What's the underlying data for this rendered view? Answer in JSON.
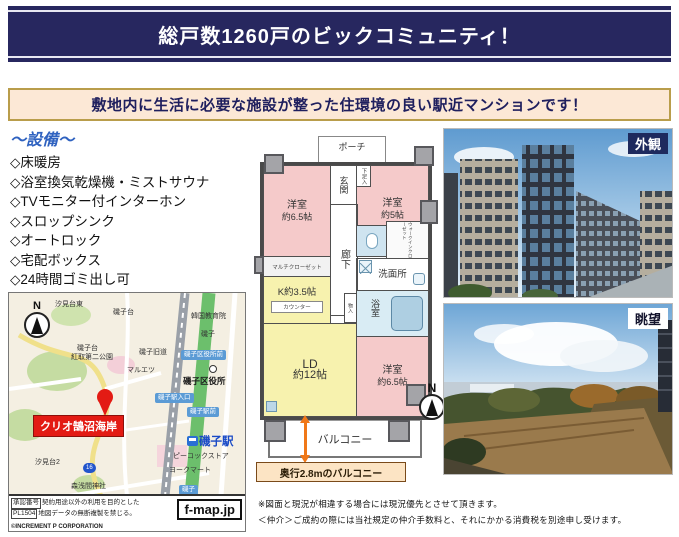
{
  "header": {
    "title": "総戸数1260戸のビックコミュニティ！"
  },
  "subheader": {
    "text": "敷地内に生活に必要な施設が整った住環境の良い駅近マンションです！"
  },
  "facilities": {
    "title": "〜設備〜",
    "items": [
      "◇床暖房",
      "◇浴室換気乾燥機・ミストサウナ",
      "◇TVモニター付インターホン",
      "◇スロップシンク",
      "◇オートロック",
      "◇宅配ボックス",
      "◇24時間ゴミ出し可"
    ]
  },
  "floorplan": {
    "porch": "ポーチ",
    "genkan": "玄関",
    "shoebox": "下足入",
    "corridor": "廊下",
    "room1_name": "洋室",
    "room1_size": "約6.5帖",
    "room2_name": "洋室",
    "room2_size": "約5帖",
    "multicloset": "マルチクローゼット",
    "kitchen": "K約3.5帖",
    "counter": "カウンター",
    "washroom": "洗面所",
    "bath": "浴室",
    "wic": "ウォークインクローゼット",
    "storage": "物入",
    "ld_name": "LD",
    "ld_size": "約12帖",
    "room3_name": "洋室",
    "room3_size": "約6.5帖",
    "balcony": "バルコニー",
    "balcony_note": "奥行2.8mのバルコニー",
    "compass": "N"
  },
  "photos": {
    "exterior_label": "外観",
    "view_label": "眺望"
  },
  "map": {
    "compass": "N",
    "marker_label": "クリオ鵠沼海岸",
    "labels": [
      {
        "text": "汐見台東"
      },
      {
        "text": "磯子台"
      },
      {
        "text": "韓国教育院"
      },
      {
        "text": "磯子"
      },
      {
        "text": "磯子台"
      },
      {
        "text": "紅取第二公園"
      },
      {
        "text": "磯子旧道"
      },
      {
        "text": "磯子区役所前"
      },
      {
        "text": "マルエツ"
      },
      {
        "text": "磯子区役所"
      },
      {
        "text": "磯子駅入口"
      },
      {
        "text": "磯子駅前"
      },
      {
        "text": "磯子駅"
      },
      {
        "text": "ピーコックストア"
      },
      {
        "text": "ヨークマート"
      },
      {
        "text": "汐見台2"
      },
      {
        "text": "森浅間神社"
      },
      {
        "text": "磯子"
      },
      {
        "text": "16"
      }
    ],
    "footer": {
      "approval_no_label": "承認番号",
      "approval_no": "PL1504",
      "line1": "契約用途以外の利用を目的とした",
      "line2": "地図データの無断複製を禁じる。",
      "copyright": "©INCREMENT P CORPORATION",
      "logo": "f-map.jp"
    }
  },
  "notes": [
    "※図面と現況が相違する場合には現況優先とさせて頂きます。",
    "＜仲介＞ご成約の際には当社規定の仲介手数料と、それにかかる消費税を別途申し受けます。"
  ],
  "colors": {
    "banner_navy": "#27275f",
    "banner_rule": "#e8e8f2",
    "subheader_bg": "#fce8d6",
    "subheader_border": "#b99d4b",
    "facilities_title_blue": "#2f62c0",
    "room_pink": "#f5caca",
    "room_yellow": "#f7f2ae",
    "bath_blue": "#d9ecf4",
    "arrow_orange": "#f07818",
    "marker_red": "#e31b14",
    "badge_blue": "#5b9bd5",
    "station_blue": "#1849c6"
  }
}
